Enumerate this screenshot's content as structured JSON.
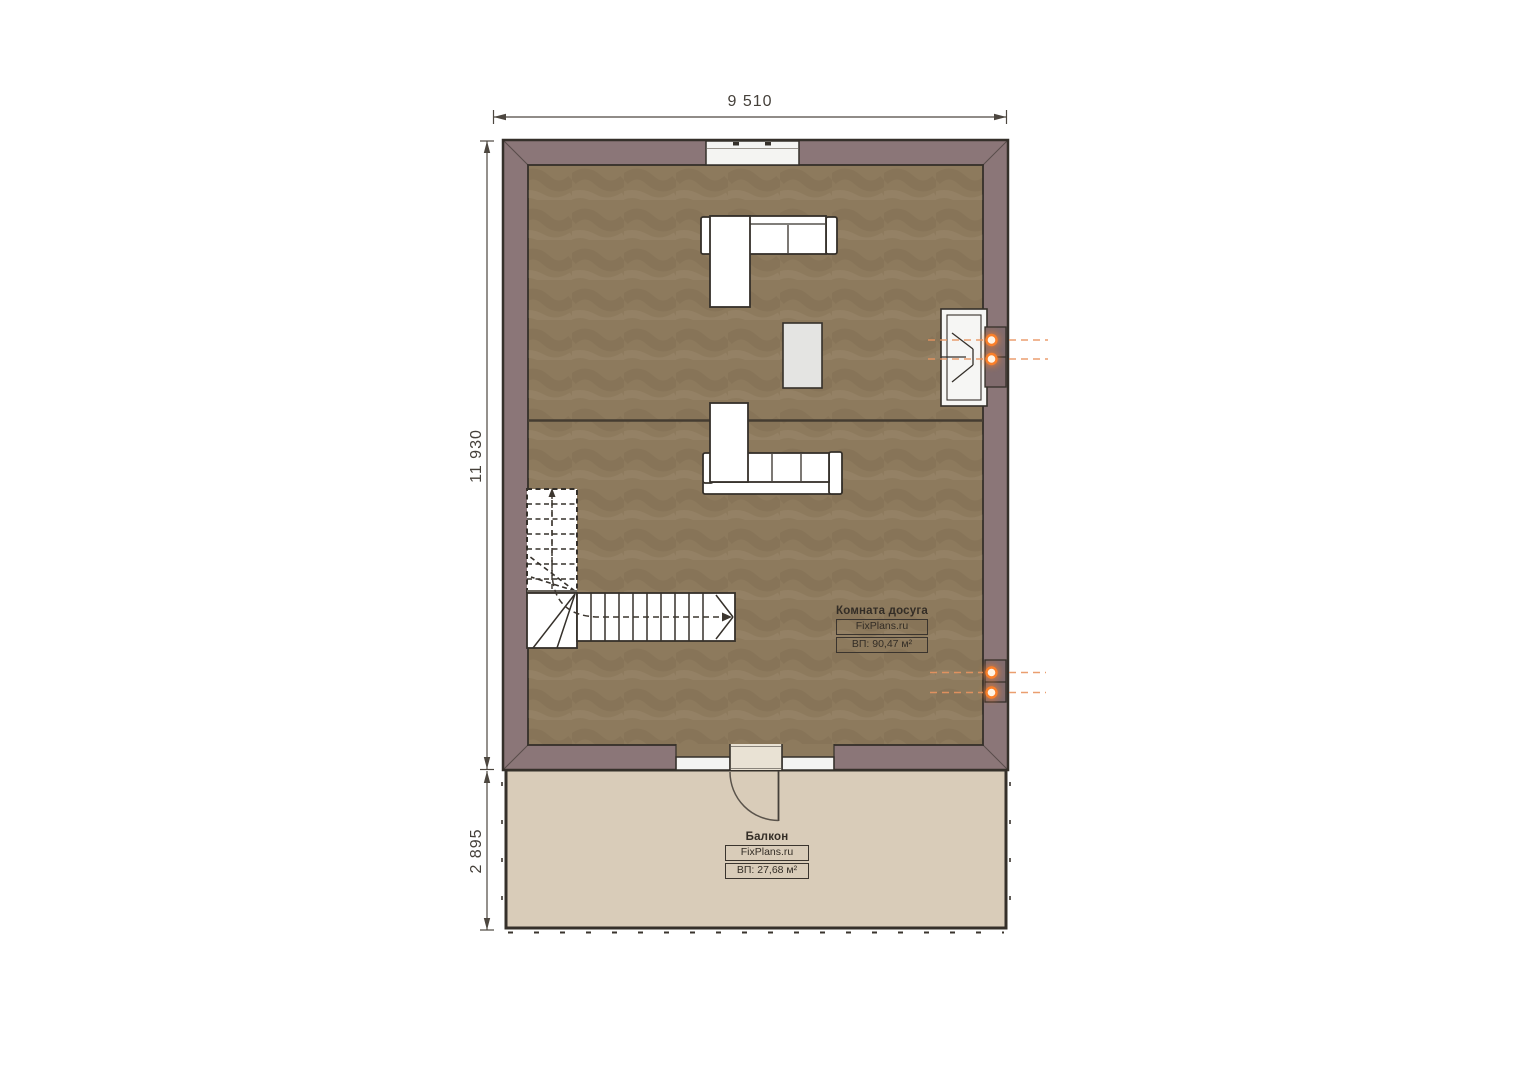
{
  "plan": {
    "dimensions": {
      "top": "9 510",
      "left_main": "11 930",
      "left_balcony": "2 895"
    },
    "rooms": {
      "leisure": {
        "name": "Комната досуга",
        "brand": "FixPlans.ru",
        "area": "ВП: 90,47 м²"
      },
      "balcony": {
        "name": "Балкон",
        "brand": "FixPlans.ru",
        "area": "ВП: 27,68 м²"
      }
    },
    "colors": {
      "wall": "#8b7678",
      "floor": "#8d7a5d",
      "balcony_floor": "#d9ccb9",
      "outline": "#35302a",
      "furniture": "#ffffff",
      "table": "#e4e4e2",
      "accent_orange": "#f97f2a"
    }
  }
}
